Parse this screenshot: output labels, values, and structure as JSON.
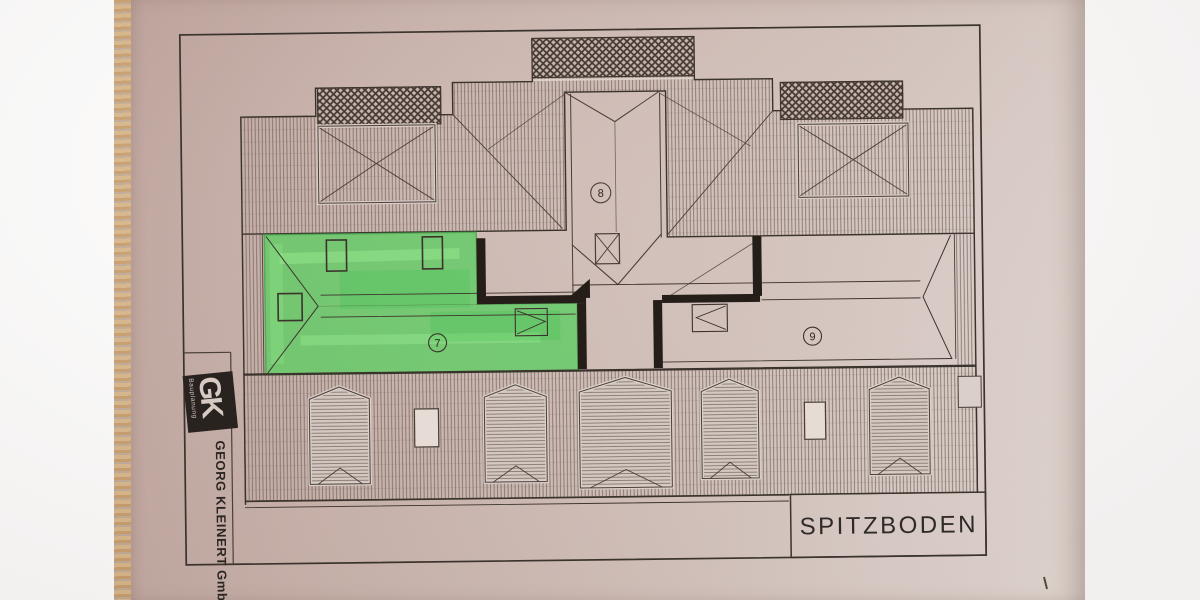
{
  "title_block": {
    "monogram": "GK",
    "tagline": "Bauplanung",
    "company": "GEORG KLEINERT GmbH"
  },
  "plan": {
    "title": "SPITZBODEN",
    "rooms": [
      {
        "number": "7",
        "highlighted": true,
        "highlight_color": "#55cf5c"
      },
      {
        "number": "8",
        "highlighted": false
      },
      {
        "number": "9",
        "highlighted": false
      }
    ]
  }
}
